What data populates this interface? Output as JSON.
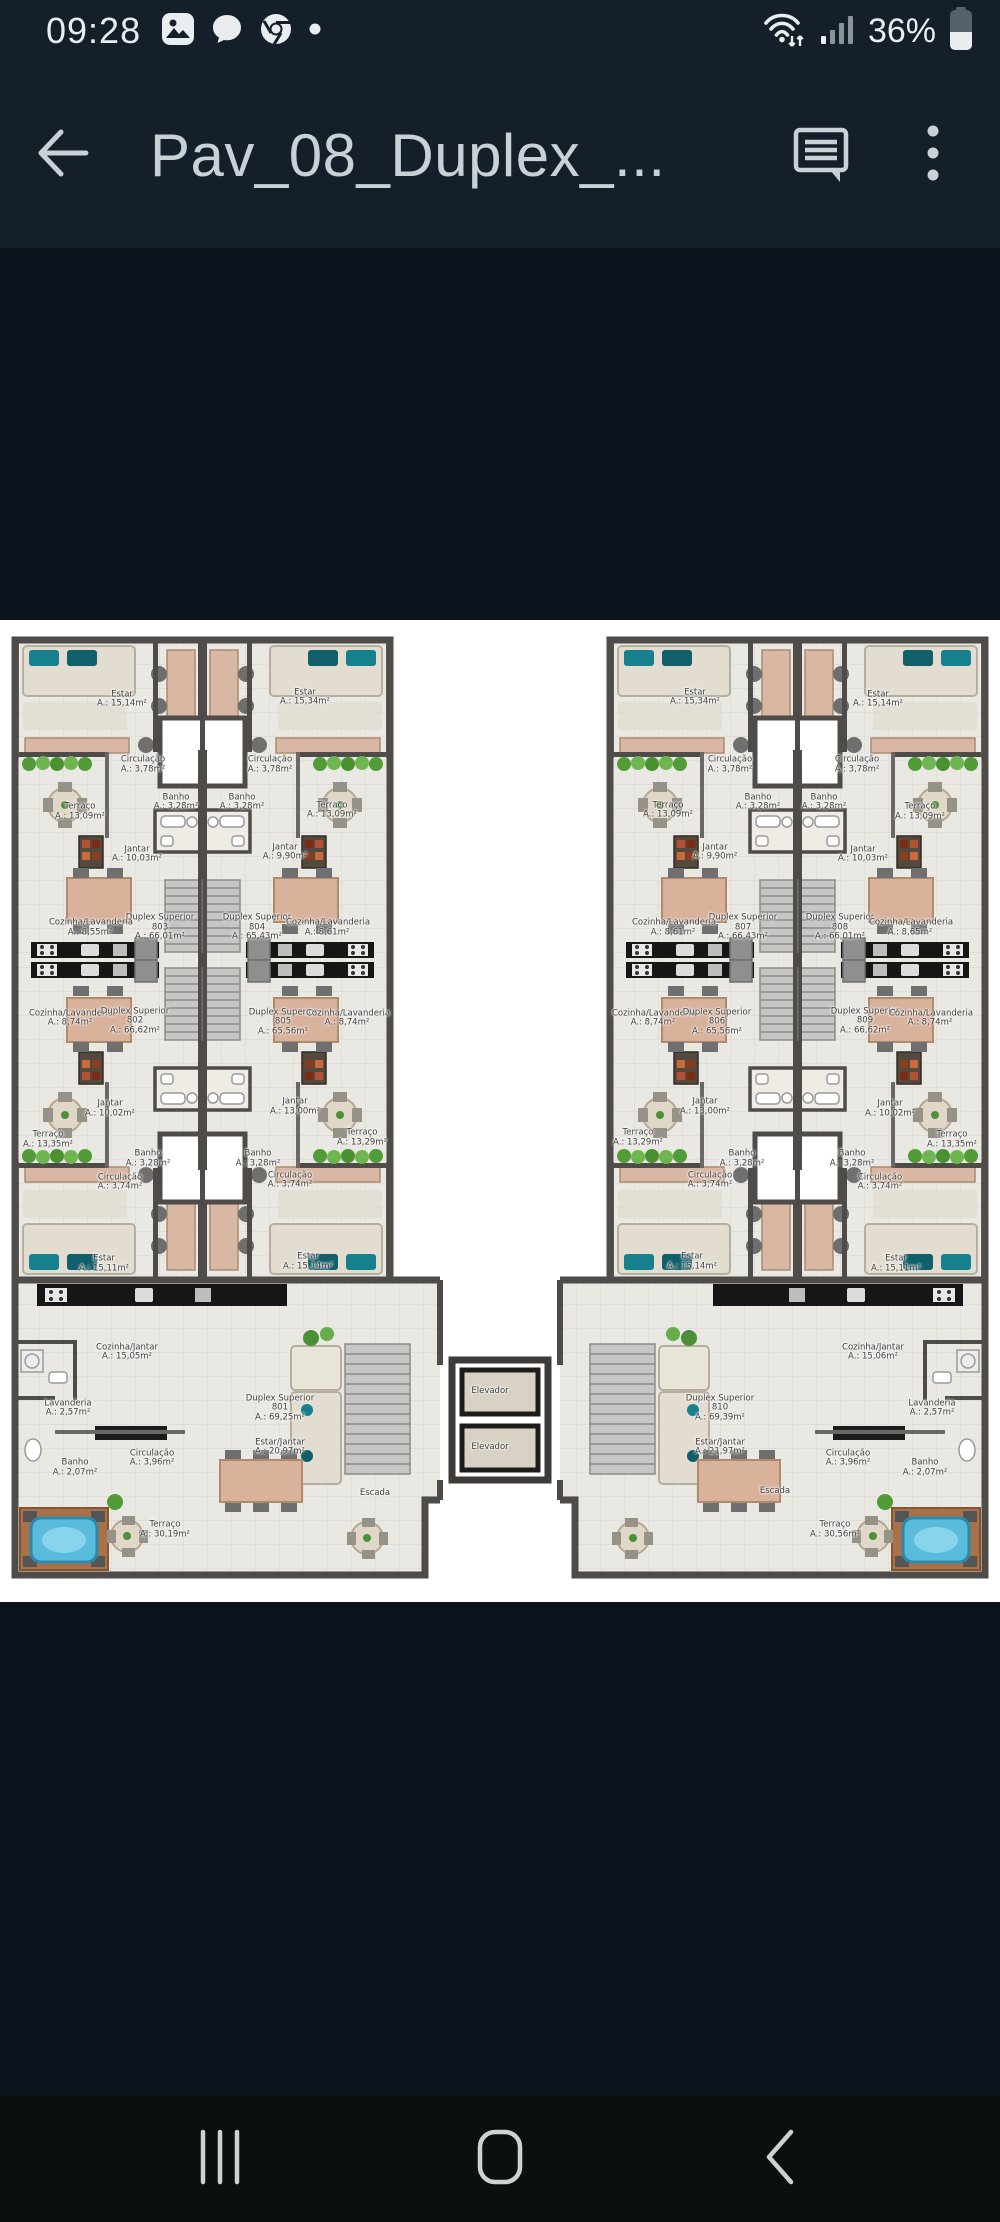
{
  "status_bar": {
    "time": "09:28",
    "battery_percent": "36%",
    "left_icons": [
      "gallery-icon",
      "messages-icon",
      "chrome-icon",
      "notification-dot"
    ],
    "right_icons": [
      "wifi-icon",
      "signal-icon",
      "battery-icon"
    ]
  },
  "app_bar": {
    "title": "Pav_08_Duplex_...",
    "back_icon": "arrow-left",
    "actions": [
      "comment-icon",
      "overflow-menu-icon"
    ]
  },
  "nav_bar": {
    "buttons": [
      "recents",
      "home",
      "back"
    ]
  },
  "colors": {
    "chrome_bg": "#141f2a",
    "letterbox_bg": "#0b141d",
    "nav_bg": "#0b100d",
    "icon": "#e9edef",
    "title": "#c9d1d7",
    "plan_wall": "#4e4b49",
    "plan_floor": "#eae8e3",
    "plan_counter": "#161616",
    "plant_green": "#529c38",
    "water_blue": "#5abcdc",
    "wood_deck": "#a9714a",
    "furniture_tan": "#d9b29c"
  },
  "floor_plan": {
    "labels": [
      {
        "name": "Estar",
        "area": "A.: 15,14m²",
        "x": 12.2,
        "y": 8.1
      },
      {
        "name": "Estar",
        "area": "A.: 15,34m²",
        "x": 30.5,
        "y": 7.9
      },
      {
        "name": "Circulação",
        "area": "A.: 3,78m²",
        "x": 14.3,
        "y": 14.8
      },
      {
        "name": "Circulação",
        "area": "A.: 3,78m²",
        "x": 27.0,
        "y": 14.8
      },
      {
        "name": "Banho",
        "area": "A.: 3,28m²",
        "x": 17.6,
        "y": 18.6
      },
      {
        "name": "Banho",
        "area": "A.: 3,28m²",
        "x": 24.2,
        "y": 18.6
      },
      {
        "name": "Terraço",
        "area": "A.: 13,09m²",
        "x": 8.0,
        "y": 19.6
      },
      {
        "name": "Terraço",
        "area": "A.: 13,09m²",
        "x": 33.2,
        "y": 19.4
      },
      {
        "name": "Jantar",
        "area": "A.: 10,03m²",
        "x": 13.7,
        "y": 23.9
      },
      {
        "name": "Jantar",
        "area": "A.: 9,90m²",
        "x": 28.5,
        "y": 23.7
      },
      {
        "name": "Duplex Superior 803",
        "area": "A.: 66,01m²",
        "x": 16.0,
        "y": 31.4
      },
      {
        "name": "Duplex Superior 804",
        "area": "A.: 65,43m²",
        "x": 25.7,
        "y": 31.4
      },
      {
        "name": "Cozinha/Lavanderia",
        "area": "A.: 8,55m²",
        "x": 9.0,
        "y": 31.4
      },
      {
        "name": "Cozinha/Lavanderia",
        "area": "A.: 8,61m²",
        "x": 32.7,
        "y": 31.4
      },
      {
        "name": "Cozinha/Lavanderia",
        "area": "A.: 8,74m²",
        "x": 7.0,
        "y": 40.6
      },
      {
        "name": "Duplex Superior 802",
        "area": "A.: 66,62m²",
        "x": 13.5,
        "y": 40.9
      },
      {
        "name": "Duplex Superior 805",
        "area": "A.: 65,56m²",
        "x": 28.3,
        "y": 41.0
      },
      {
        "name": "Cozinha/Lavanderia",
        "area": "A.: 8,74m²",
        "x": 34.7,
        "y": 40.6
      },
      {
        "name": "Jantar",
        "area": "A.: 10,02m²",
        "x": 11.0,
        "y": 49.8
      },
      {
        "name": "Jantar",
        "area": "A.: 13,00m²",
        "x": 29.5,
        "y": 49.6
      },
      {
        "name": "Terraço",
        "area": "A.: 13,35m²",
        "x": 4.8,
        "y": 53.0
      },
      {
        "name": "Terraço",
        "area": "A.: 13,29m²",
        "x": 36.2,
        "y": 52.8
      },
      {
        "name": "Banho",
        "area": "A.: 3,28m²",
        "x": 14.8,
        "y": 54.9
      },
      {
        "name": "Banho",
        "area": "A.: 3,28m²",
        "x": 25.8,
        "y": 54.9
      },
      {
        "name": "Circulação",
        "area": "A.: 3,74m²",
        "x": 12.0,
        "y": 57.3
      },
      {
        "name": "Circulação",
        "area": "A.: 3,74m²",
        "x": 29.0,
        "y": 57.1
      },
      {
        "name": "Estar",
        "area": "A.: 15,11m²",
        "x": 10.4,
        "y": 65.6
      },
      {
        "name": "Estar",
        "area": "A.: 15,14m²",
        "x": 30.8,
        "y": 65.4
      },
      {
        "name": "Estar",
        "area": "A.: 15,34m²",
        "x": 69.5,
        "y": 7.9
      },
      {
        "name": "Estar",
        "area": "A.: 15,14m²",
        "x": 87.8,
        "y": 8.1
      },
      {
        "name": "Circulação",
        "area": "A.: 3,78m²",
        "x": 73.0,
        "y": 14.8
      },
      {
        "name": "Circulação",
        "area": "A.: 3,78m²",
        "x": 85.7,
        "y": 14.8
      },
      {
        "name": "Banho",
        "area": "A.: 3,28m²",
        "x": 75.8,
        "y": 18.6
      },
      {
        "name": "Banho",
        "area": "A.: 3,28m²",
        "x": 82.4,
        "y": 18.6
      },
      {
        "name": "Terraço",
        "area": "A.: 13,09m²",
        "x": 66.8,
        "y": 19.4
      },
      {
        "name": "Terraço",
        "area": "A.: 13,09m²",
        "x": 92.0,
        "y": 19.6
      },
      {
        "name": "Jantar",
        "area": "A.: 9,90m²",
        "x": 71.5,
        "y": 23.7
      },
      {
        "name": "Jantar",
        "area": "A.: 10,03m²",
        "x": 86.3,
        "y": 23.9
      },
      {
        "name": "Duplex Superior 807",
        "area": "A.: 66,43m²",
        "x": 74.3,
        "y": 31.4
      },
      {
        "name": "Duplex Superior 808",
        "area": "A.: 66,01m²",
        "x": 84.0,
        "y": 31.4
      },
      {
        "name": "Cozinha/Lavanderia",
        "area": "A.: 8,61m²",
        "x": 67.3,
        "y": 31.4
      },
      {
        "name": "Cozinha/Lavanderia",
        "area": "A.: 8,65m²",
        "x": 91.0,
        "y": 31.4
      },
      {
        "name": "Cozinha/Lavanderia",
        "area": "A.: 8,74m²",
        "x": 65.3,
        "y": 40.6
      },
      {
        "name": "Duplex Superior 806",
        "area": "A.: 65,56m²",
        "x": 71.7,
        "y": 41.0
      },
      {
        "name": "Duplex Superior 809",
        "area": "A.: 66,62m²",
        "x": 86.5,
        "y": 40.9
      },
      {
        "name": "Cozinha/Lavanderia",
        "area": "A.: 8,74m²",
        "x": 93.0,
        "y": 40.6
      },
      {
        "name": "Jantar",
        "area": "A.: 13,00m²",
        "x": 70.5,
        "y": 49.6
      },
      {
        "name": "Jantar",
        "area": "A.: 10,02m²",
        "x": 89.0,
        "y": 49.8
      },
      {
        "name": "Terraço",
        "area": "A.: 13,29m²",
        "x": 63.8,
        "y": 52.8
      },
      {
        "name": "Terraço",
        "area": "A.: 13,35m²",
        "x": 95.2,
        "y": 53.0
      },
      {
        "name": "Banho",
        "area": "A.: 3,28m²",
        "x": 74.2,
        "y": 54.9
      },
      {
        "name": "Banho",
        "area": "A.: 3,28m²",
        "x": 85.2,
        "y": 54.9
      },
      {
        "name": "Circulação",
        "area": "A.: 3,74m²",
        "x": 71.0,
        "y": 57.1
      },
      {
        "name": "Circulação",
        "area": "A.: 3,74m²",
        "x": 88.0,
        "y": 57.3
      },
      {
        "name": "Estar",
        "area": "A.: 15,14m²",
        "x": 69.2,
        "y": 65.4
      },
      {
        "name": "Estar",
        "area": "A.: 15,11m²",
        "x": 89.6,
        "y": 65.6
      },
      {
        "name": "Cozinha/Jantar",
        "area": "A.: 15,05m²",
        "x": 12.7,
        "y": 74.6
      },
      {
        "name": "Lavanderia",
        "area": "A.: 2,57m²",
        "x": 6.8,
        "y": 80.3
      },
      {
        "name": "Banho",
        "area": "A.: 2,07m²",
        "x": 7.5,
        "y": 86.4
      },
      {
        "name": "Duplex Superior 801",
        "area": "A.: 69,25m²",
        "x": 28.0,
        "y": 80.3
      },
      {
        "name": "Estar/Jantar",
        "area": "A.: 20,97m²",
        "x": 28.0,
        "y": 84.3
      },
      {
        "name": "Circulação",
        "area": "A.: 3,96m²",
        "x": 15.2,
        "y": 85.4
      },
      {
        "name": "Terraço",
        "area": "A.: 30,19m²",
        "x": 16.5,
        "y": 92.7
      },
      {
        "name": "Escada",
        "area": "",
        "x": 37.5,
        "y": 89.0
      },
      {
        "name": "Elevador",
        "area": "",
        "x": 49.0,
        "y": 78.6
      },
      {
        "name": "Elevador",
        "area": "",
        "x": 49.0,
        "y": 84.3
      },
      {
        "name": "Cozinha/Jantar",
        "area": "A.: 15,06m²",
        "x": 87.3,
        "y": 74.6
      },
      {
        "name": "Lavanderia",
        "area": "A.: 2,57m²",
        "x": 93.2,
        "y": 80.3
      },
      {
        "name": "Banho",
        "area": "A.: 2,07m²",
        "x": 92.5,
        "y": 86.4
      },
      {
        "name": "Duplex Superior 810",
        "area": "A.: 69,39m²",
        "x": 72.0,
        "y": 80.3
      },
      {
        "name": "Estar/Jantar",
        "area": "A.: 21,97m²",
        "x": 72.0,
        "y": 84.3
      },
      {
        "name": "Circulação",
        "area": "A.: 3,96m²",
        "x": 84.8,
        "y": 85.4
      },
      {
        "name": "Terraço",
        "area": "A.: 30,56m²",
        "x": 83.5,
        "y": 92.7
      },
      {
        "name": "Escada",
        "area": "",
        "x": 77.5,
        "y": 88.8
      }
    ]
  }
}
